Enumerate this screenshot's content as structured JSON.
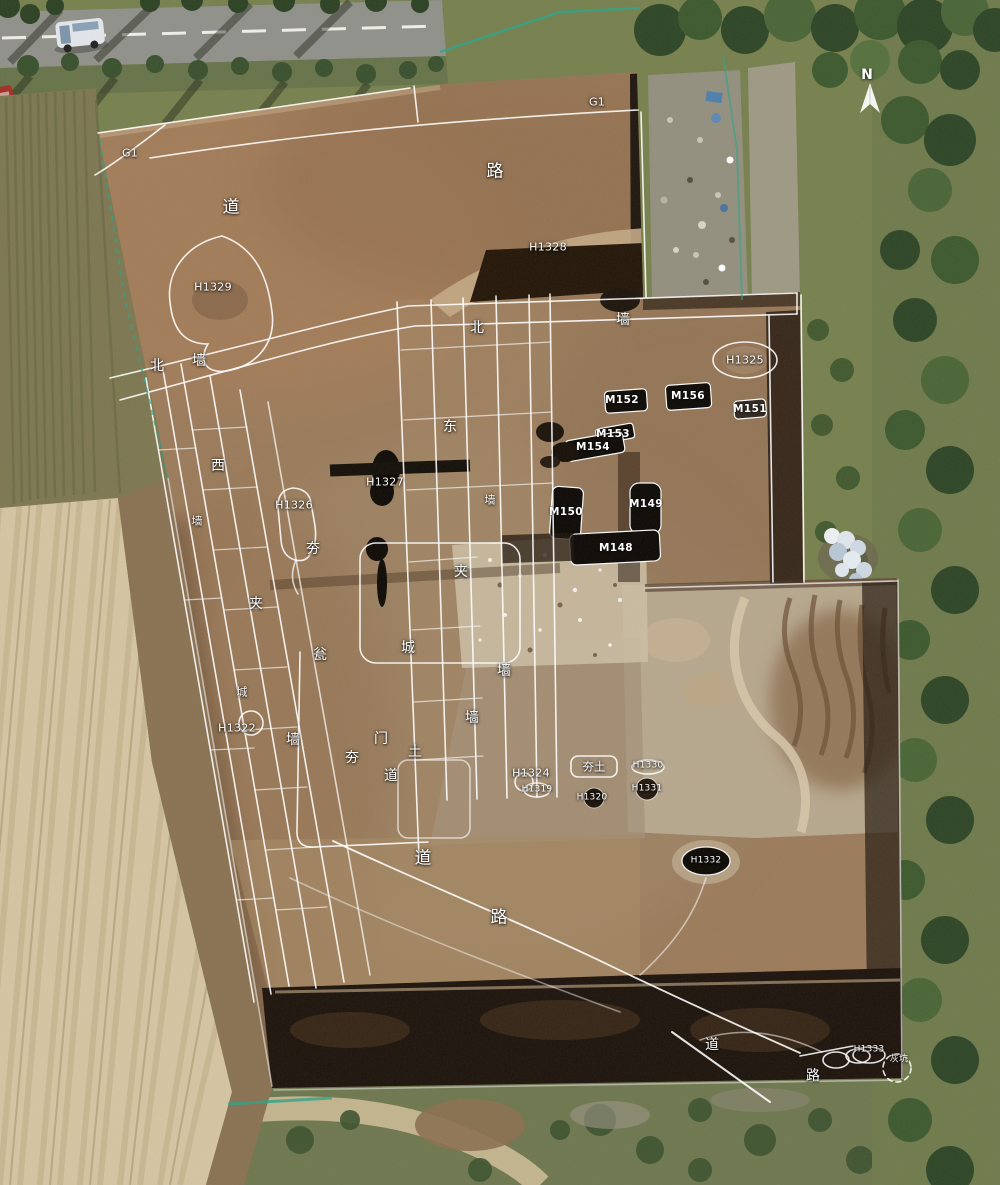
{
  "canvas": {
    "width": 1000,
    "height": 1185
  },
  "colors": {
    "annotation_line": "#ffffff",
    "label_text": "#ffffff",
    "soil_brown": "#9b7c5c",
    "pale_field": "#d5c5a3",
    "vegetation_green": "#77814f",
    "road_gray": "#90918b",
    "pit_black": "#14100a",
    "fence_green": "#35a387"
  },
  "compass": {
    "label": "N"
  },
  "labels": [
    {
      "name": "label-g1-west",
      "text": "G1",
      "x": 130,
      "y": 153,
      "kind": "id"
    },
    {
      "name": "label-g1-north",
      "text": "G1",
      "x": 597,
      "y": 102,
      "kind": "id"
    },
    {
      "name": "label-lu-north",
      "text": "路",
      "x": 495,
      "y": 172,
      "kind": "char-lg"
    },
    {
      "name": "label-dao-northwest",
      "text": "道",
      "x": 231,
      "y": 208,
      "kind": "char-lg"
    },
    {
      "name": "label-h1329",
      "text": "H1329",
      "x": 213,
      "y": 287,
      "kind": "id"
    },
    {
      "name": "label-h1328",
      "text": "H1328",
      "x": 548,
      "y": 247,
      "kind": "id"
    },
    {
      "name": "label-bei-northwest",
      "text": "北",
      "x": 157,
      "y": 366,
      "kind": "char"
    },
    {
      "name": "label-qiang-northwest",
      "text": "墙",
      "x": 199,
      "y": 361,
      "kind": "char"
    },
    {
      "name": "label-bei-north-wall",
      "text": "北",
      "x": 477,
      "y": 328,
      "kind": "char"
    },
    {
      "name": "label-qiang-north-wall",
      "text": "墙",
      "x": 623,
      "y": 320,
      "kind": "char"
    },
    {
      "name": "label-h1325",
      "text": "H1325",
      "x": 745,
      "y": 360,
      "kind": "id"
    },
    {
      "name": "label-m152",
      "text": "M152",
      "x": 622,
      "y": 400,
      "kind": "m-id"
    },
    {
      "name": "label-m156",
      "text": "M156",
      "x": 688,
      "y": 396,
      "kind": "m-id"
    },
    {
      "name": "label-m151",
      "text": "M151",
      "x": 750,
      "y": 409,
      "kind": "m-id"
    },
    {
      "name": "label-m153",
      "text": "M153",
      "x": 613,
      "y": 434,
      "kind": "m-id"
    },
    {
      "name": "label-m154",
      "text": "M154",
      "x": 593,
      "y": 447,
      "kind": "m-id"
    },
    {
      "name": "label-dong-east-wall",
      "text": "东",
      "x": 450,
      "y": 427,
      "kind": "char"
    },
    {
      "name": "label-qiang-east-wall",
      "text": "墙",
      "x": 490,
      "y": 500,
      "kind": "char-sm"
    },
    {
      "name": "label-jia-east",
      "text": "夹",
      "x": 461,
      "y": 572,
      "kind": "char"
    },
    {
      "name": "label-cheng-center",
      "text": "城",
      "x": 408,
      "y": 648,
      "kind": "char"
    },
    {
      "name": "label-qiang-center-east",
      "text": "墙",
      "x": 504,
      "y": 671,
      "kind": "char"
    },
    {
      "name": "label-qiang-center",
      "text": "墙",
      "x": 472,
      "y": 718,
      "kind": "char"
    },
    {
      "name": "label-xi-west-wall",
      "text": "西",
      "x": 218,
      "y": 466,
      "kind": "char"
    },
    {
      "name": "label-qiang-west-upper",
      "text": "墙",
      "x": 197,
      "y": 521,
      "kind": "char-sm"
    },
    {
      "name": "label-hang-center",
      "text": "夯",
      "x": 313,
      "y": 549,
      "kind": "char"
    },
    {
      "name": "label-jia-west",
      "text": "夹",
      "x": 256,
      "y": 604,
      "kind": "char"
    },
    {
      "name": "label-weng-barbican",
      "text": "瓮",
      "x": 320,
      "y": 655,
      "kind": "char"
    },
    {
      "name": "label-cheng-west",
      "text": "城",
      "x": 242,
      "y": 692,
      "kind": "char-sm"
    },
    {
      "name": "label-qiang-west-lower",
      "text": "墙",
      "x": 293,
      "y": 740,
      "kind": "char"
    },
    {
      "name": "label-h1326",
      "text": "H1326",
      "x": 294,
      "y": 505,
      "kind": "id"
    },
    {
      "name": "label-h1327",
      "text": "H1327",
      "x": 385,
      "y": 482,
      "kind": "id"
    },
    {
      "name": "label-h1322",
      "text": "H1322",
      "x": 237,
      "y": 728,
      "kind": "id"
    },
    {
      "name": "label-men-gate",
      "text": "门",
      "x": 381,
      "y": 739,
      "kind": "char"
    },
    {
      "name": "label-tu-gate",
      "text": "土",
      "x": 415,
      "y": 752,
      "kind": "char"
    },
    {
      "name": "label-hang-gate",
      "text": "夯",
      "x": 352,
      "y": 758,
      "kind": "char"
    },
    {
      "name": "label-dao-gate",
      "text": "道",
      "x": 391,
      "y": 776,
      "kind": "char"
    },
    {
      "name": "label-m150",
      "text": "M150",
      "x": 566,
      "y": 512,
      "kind": "m-id"
    },
    {
      "name": "label-m149",
      "text": "M149",
      "x": 646,
      "y": 504,
      "kind": "m-id"
    },
    {
      "name": "label-m148",
      "text": "M148",
      "x": 616,
      "y": 548,
      "kind": "m-id"
    },
    {
      "name": "label-hangtu-box",
      "text": "夯土",
      "x": 594,
      "y": 767,
      "kind": "boxed"
    },
    {
      "name": "label-h1330",
      "text": "H1330",
      "x": 648,
      "y": 766,
      "kind": "id-sm"
    },
    {
      "name": "label-h1331",
      "text": "H1331",
      "x": 647,
      "y": 789,
      "kind": "id-sm"
    },
    {
      "name": "label-h1320",
      "text": "H1320",
      "x": 592,
      "y": 798,
      "kind": "id-sm"
    },
    {
      "name": "label-h1319",
      "text": "H1319",
      "x": 537,
      "y": 790,
      "kind": "id-sm"
    },
    {
      "name": "label-h1324",
      "text": "H1324",
      "x": 531,
      "y": 773,
      "kind": "id"
    },
    {
      "name": "label-dao-road-mid",
      "text": "道",
      "x": 423,
      "y": 859,
      "kind": "char-lg"
    },
    {
      "name": "label-lu-road-mid",
      "text": "路",
      "x": 499,
      "y": 918,
      "kind": "char-lg"
    },
    {
      "name": "label-h1332",
      "text": "H1332",
      "x": 706,
      "y": 861,
      "kind": "id-sm"
    },
    {
      "name": "label-dao-road-south",
      "text": "道",
      "x": 712,
      "y": 1045,
      "kind": "char"
    },
    {
      "name": "label-lu-road-south",
      "text": "路",
      "x": 813,
      "y": 1076,
      "kind": "char"
    },
    {
      "name": "label-h1333",
      "text": "H1333",
      "x": 869,
      "y": 1050,
      "kind": "id-sm"
    },
    {
      "name": "label-huikeng",
      "text": "灰坑",
      "x": 899,
      "y": 1060,
      "kind": "id-sm"
    }
  ]
}
